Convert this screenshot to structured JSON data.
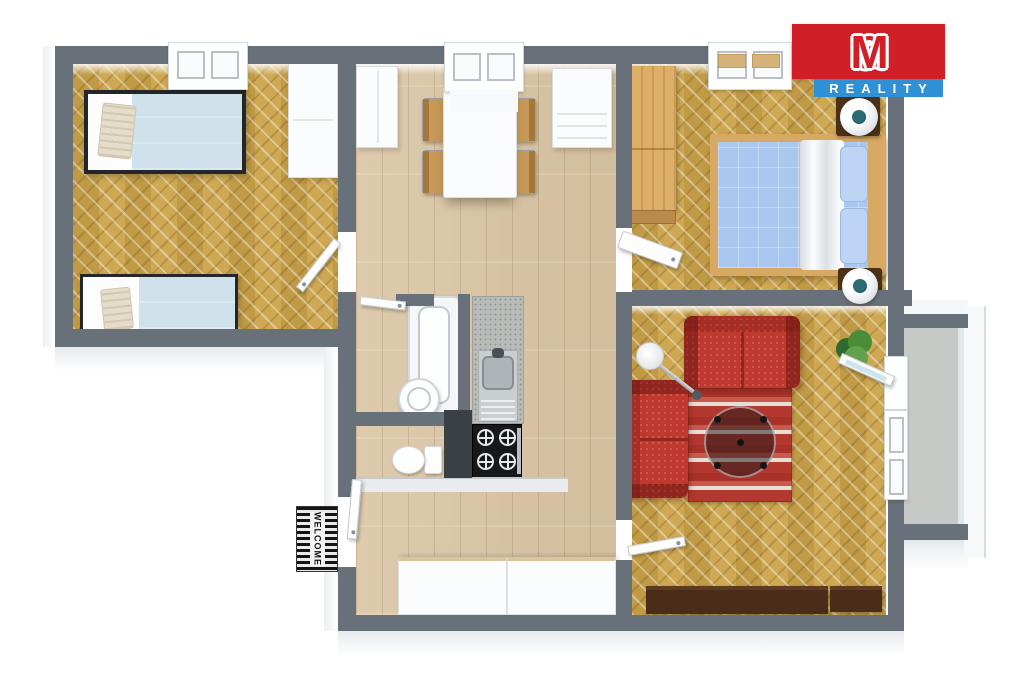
{
  "branding": {
    "logo_m1": "M",
    "logo_amp": "&",
    "logo_m2": "M",
    "logo_reality": "REALITY",
    "logo_red": "#d01f26",
    "logo_blue": "#3090d6"
  },
  "entrance": {
    "doormat_text": "WELCOME"
  },
  "palette": {
    "wall_gray": "#687079",
    "herringbone_floor": "#c8a34f",
    "plank_floor": "#dbc8ab",
    "balcony_floor": "#c7c9c7",
    "sofa_red": "#c0392f",
    "rug_red": "#b23830",
    "bed_single_blue": "#cfe2ec",
    "bed_double_blue": "#a9c7ef",
    "oak_wood": "#ddae66",
    "sideboard_brown": "#4a2d18",
    "counter_gray": "#b7bcb8"
  },
  "plan": {
    "type": "3d-top-down-floor-plan",
    "rooms": [
      {
        "name": "bedroom-left",
        "furniture": [
          "single-bed",
          "single-bed",
          "white-wardrobe",
          "window"
        ]
      },
      {
        "name": "kitchen-dining-hall",
        "furniture": [
          "dining-table",
          "four-chairs",
          "tall-cabinet",
          "drawer-dresser",
          "kitchen-counter",
          "sink",
          "gas-stove",
          "hall-cabinets",
          "window"
        ]
      },
      {
        "name": "bathroom-wc",
        "furniture": [
          "bathtub",
          "round-sink",
          "toilet"
        ]
      },
      {
        "name": "bedroom-right",
        "furniture": [
          "double-bed",
          "oak-wardrobe",
          "two-ball-speakers",
          "window"
        ]
      },
      {
        "name": "living-room",
        "furniture": [
          "red-sofa",
          "red-loveseat",
          "striped-rug",
          "round-coffee-table",
          "arc-floor-lamp",
          "plant",
          "tv-sideboard",
          "balcony-door",
          "window"
        ]
      },
      {
        "name": "balcony",
        "furniture": []
      }
    ]
  }
}
